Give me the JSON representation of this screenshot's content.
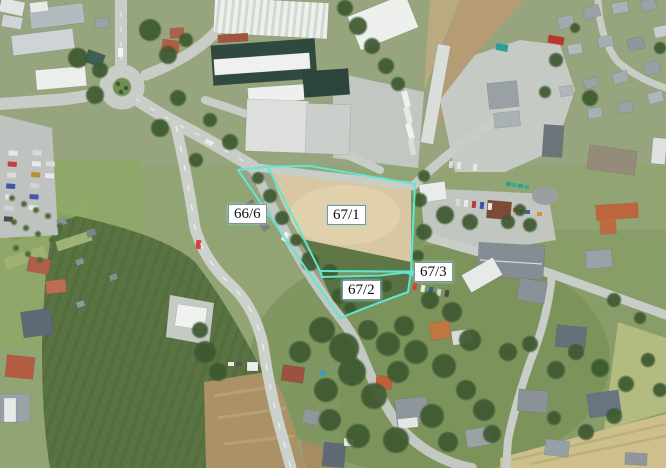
{
  "map": {
    "overlay_color": "#5ee7d3",
    "label_background": "#ffffff",
    "label_border_color": "#7f929b",
    "label_text_color": "#0d0d0d",
    "parcels": [
      {
        "label": "66/6"
      },
      {
        "label": "67/1"
      },
      {
        "label": "67/2"
      },
      {
        "label": "67/3"
      }
    ]
  }
}
